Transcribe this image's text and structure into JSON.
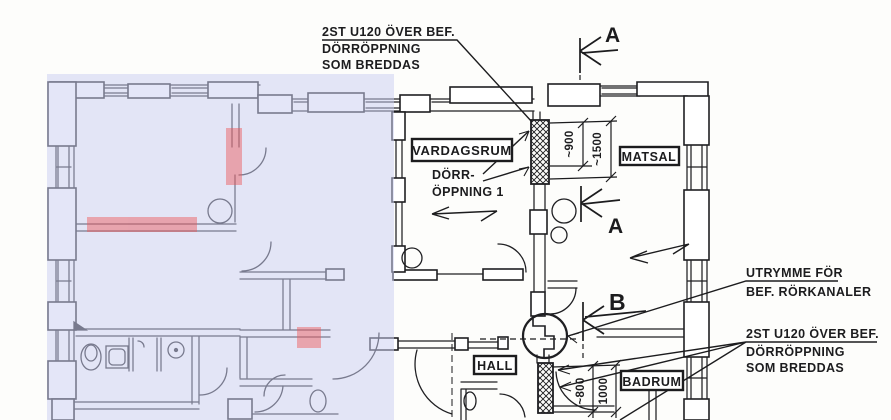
{
  "drawing": {
    "type": "architectural-floor-plan",
    "language": "Swedish"
  },
  "colors": {
    "ink": "#1c1c1e",
    "paper": "#fdfdfb",
    "highlight_zone": "#e2e4f7",
    "highlight_red": "#f2a2a2"
  },
  "notes": {
    "top": {
      "line1": "2ST U120 ÖVER BEF.",
      "line2": "DÖRRÖPPNING",
      "line3": "SOM BREDDAS"
    },
    "door": {
      "line1": "DÖRR-",
      "line2": "ÖPPNING 1"
    },
    "pipe": {
      "line1": "UTRYMME FÖR",
      "line2": "BEF. RÖRKANALER"
    },
    "right": {
      "line1": "2ST U120 ÖVER BEF.",
      "line2": "DÖRRÖPPNING",
      "line3": "SOM BREDDAS"
    }
  },
  "rooms": {
    "vardagsrum": "VARDAGSRUM",
    "matsal": "MATSAL",
    "hall": "HALL",
    "badrum": "BADRUM"
  },
  "section_markers": {
    "a_top": "A",
    "a_mid": "A",
    "b": "B"
  },
  "dimensions": {
    "d900": "~900",
    "d1500": "~1500",
    "d800": "~800",
    "d1000": "1000"
  }
}
